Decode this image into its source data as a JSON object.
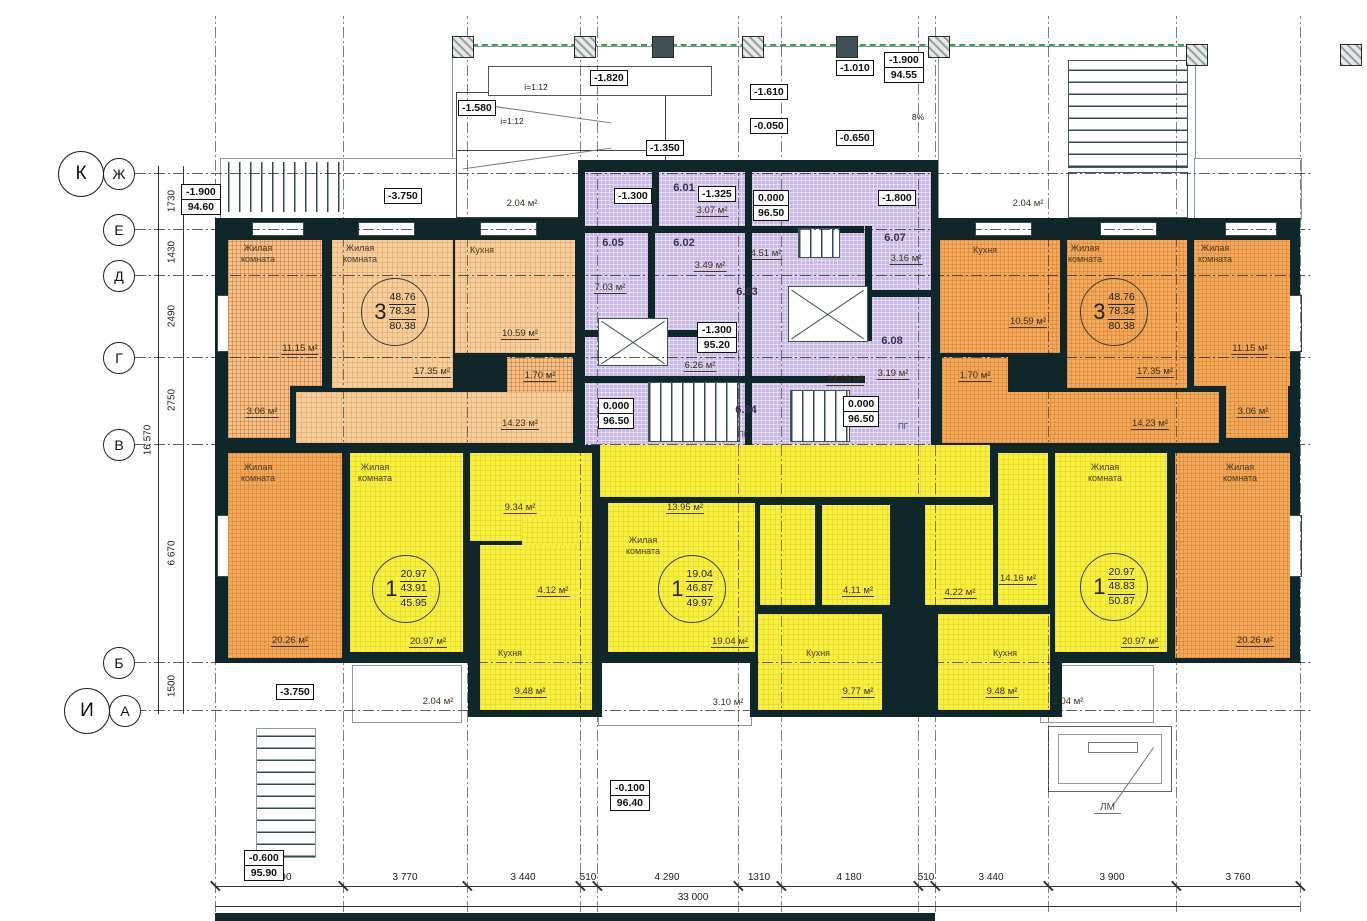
{
  "plan": {
    "room_labels": {
      "living": "Жилая\nкомната",
      "kitchen": "Кухня"
    },
    "apartments": [
      {
        "rooms": "3",
        "v1": "48.76",
        "v2": "78.34",
        "v3": "80.38"
      },
      {
        "rooms": "3",
        "v1": "48.76",
        "v2": "78.34",
        "v3": "80.38"
      },
      {
        "rooms": "1",
        "v1": "20.97",
        "v2": "43.91",
        "v3": "45.95"
      },
      {
        "rooms": "1",
        "v1": "19.04",
        "v2": "46.87",
        "v3": "49.97"
      },
      {
        "rooms": "1",
        "v1": "20.97",
        "v2": "48.83",
        "v3": "50.87"
      }
    ],
    "areas": {
      "tl_room_small": "11.15 м²",
      "tl_kitchen": "10.59 м²",
      "tl_wc": "1.70 м²",
      "tl_hall": "17.35 м²",
      "tl_bath": "3.06 м²",
      "tl_corr": "14.23 м²",
      "tl_balcony": "2.04 м²",
      "tr_kitchen": "10.59 м²",
      "tr_wc": "1.70 м²",
      "tr_room_small": "11.15 м²",
      "tr_hall": "17.35 м²",
      "tr_bath": "3.06 м²",
      "tr_corr": "14.23 м²",
      "tr_balcony": "2.04 м²",
      "c601": "3.07 м²",
      "c605": "7.03 м²",
      "c602": "3.49 м²",
      "c_corr1": "4.51 м²",
      "c607": "3.16 м²",
      "c608": "3.19 м²",
      "c_corr2": "6.26 м²",
      "c_corr3": "22.26 м²",
      "bl_room": "20.26 м²",
      "bl_hall": "9.34 м²",
      "bl_bath": "4.12 м²",
      "bl_living": "20.97 м²",
      "bl_kitchen": "9.48 м²",
      "bl_balcony": "2.04 м²",
      "bc_hall": "13.95 м²",
      "bc_living": "19.04 м²",
      "bc_balcony": "3.10 м²",
      "bc_kitchen": "9.77 м²",
      "bc_bath1": "4.11 м²",
      "bc_bath2": "4.22 м²",
      "br_hall": "14.16 м²",
      "br_kitchen": "9.48 м²",
      "br_living": "20.97 м²",
      "br_room": "20.26 м²",
      "br_balcony": "2.04 м²"
    },
    "room_numbers": {
      "r601": "6.01",
      "r602": "6.02",
      "r603": "6.03",
      "r604": "6.04",
      "r605": "6.05",
      "r607": "6.07",
      "r608": "6.08"
    },
    "elevations": {
      "tl": {
        "a": "-1.900",
        "b": "94.60"
      },
      "tr": {
        "a": "-1.900",
        "b": "94.55"
      },
      "entry_top": {
        "a": "0.000",
        "b": "96.50"
      },
      "core_mid": {
        "a": "-1.300",
        "b": "95.20"
      },
      "entry_bl": {
        "a": "0.000",
        "b": "96.50"
      },
      "entry_br": {
        "a": "0.000",
        "b": "96.50"
      },
      "stair_bl": {
        "a": "-0.600",
        "b": "95.90"
      },
      "front": {
        "a": "-0.100",
        "b": "96.40"
      },
      "s_3750_top": "-3.750",
      "s_3750_bot": "-3.750",
      "s_1580": "-1.580",
      "s_1820": "-1.820",
      "s_1350": "-1.350",
      "s_1610": "-1.610",
      "s_0050": "-0.050",
      "s_1010": "-1.010",
      "s_0650": "-0.650",
      "s_1300": "-1.300",
      "s_1325": "-1.325",
      "s_1800": "-1.800"
    },
    "slopes": {
      "ramp1": "i=1:12",
      "ramp2": "i=1:12",
      "pct": "8%"
    },
    "marks": {
      "lm": "ЛМ",
      "pg1": "ПГ",
      "pg2": "ПГ"
    },
    "axes": {
      "k": "К",
      "zh": "Ж",
      "e": "Е",
      "d": "Д",
      "g": "Г",
      "v": "В",
      "b": "Б",
      "i": "И",
      "a": "А"
    },
    "dims": {
      "left": [
        "1730",
        "1430",
        "2490",
        "2750",
        "6 670",
        "1500"
      ],
      "left_total": "16 570",
      "bottom": [
        "3 890",
        "3 770",
        "3 440",
        "510",
        "4 290",
        "1310",
        "4 180",
        "510",
        "3 440",
        "3 900",
        "3 760"
      ],
      "bottom_total": "33 000"
    }
  }
}
